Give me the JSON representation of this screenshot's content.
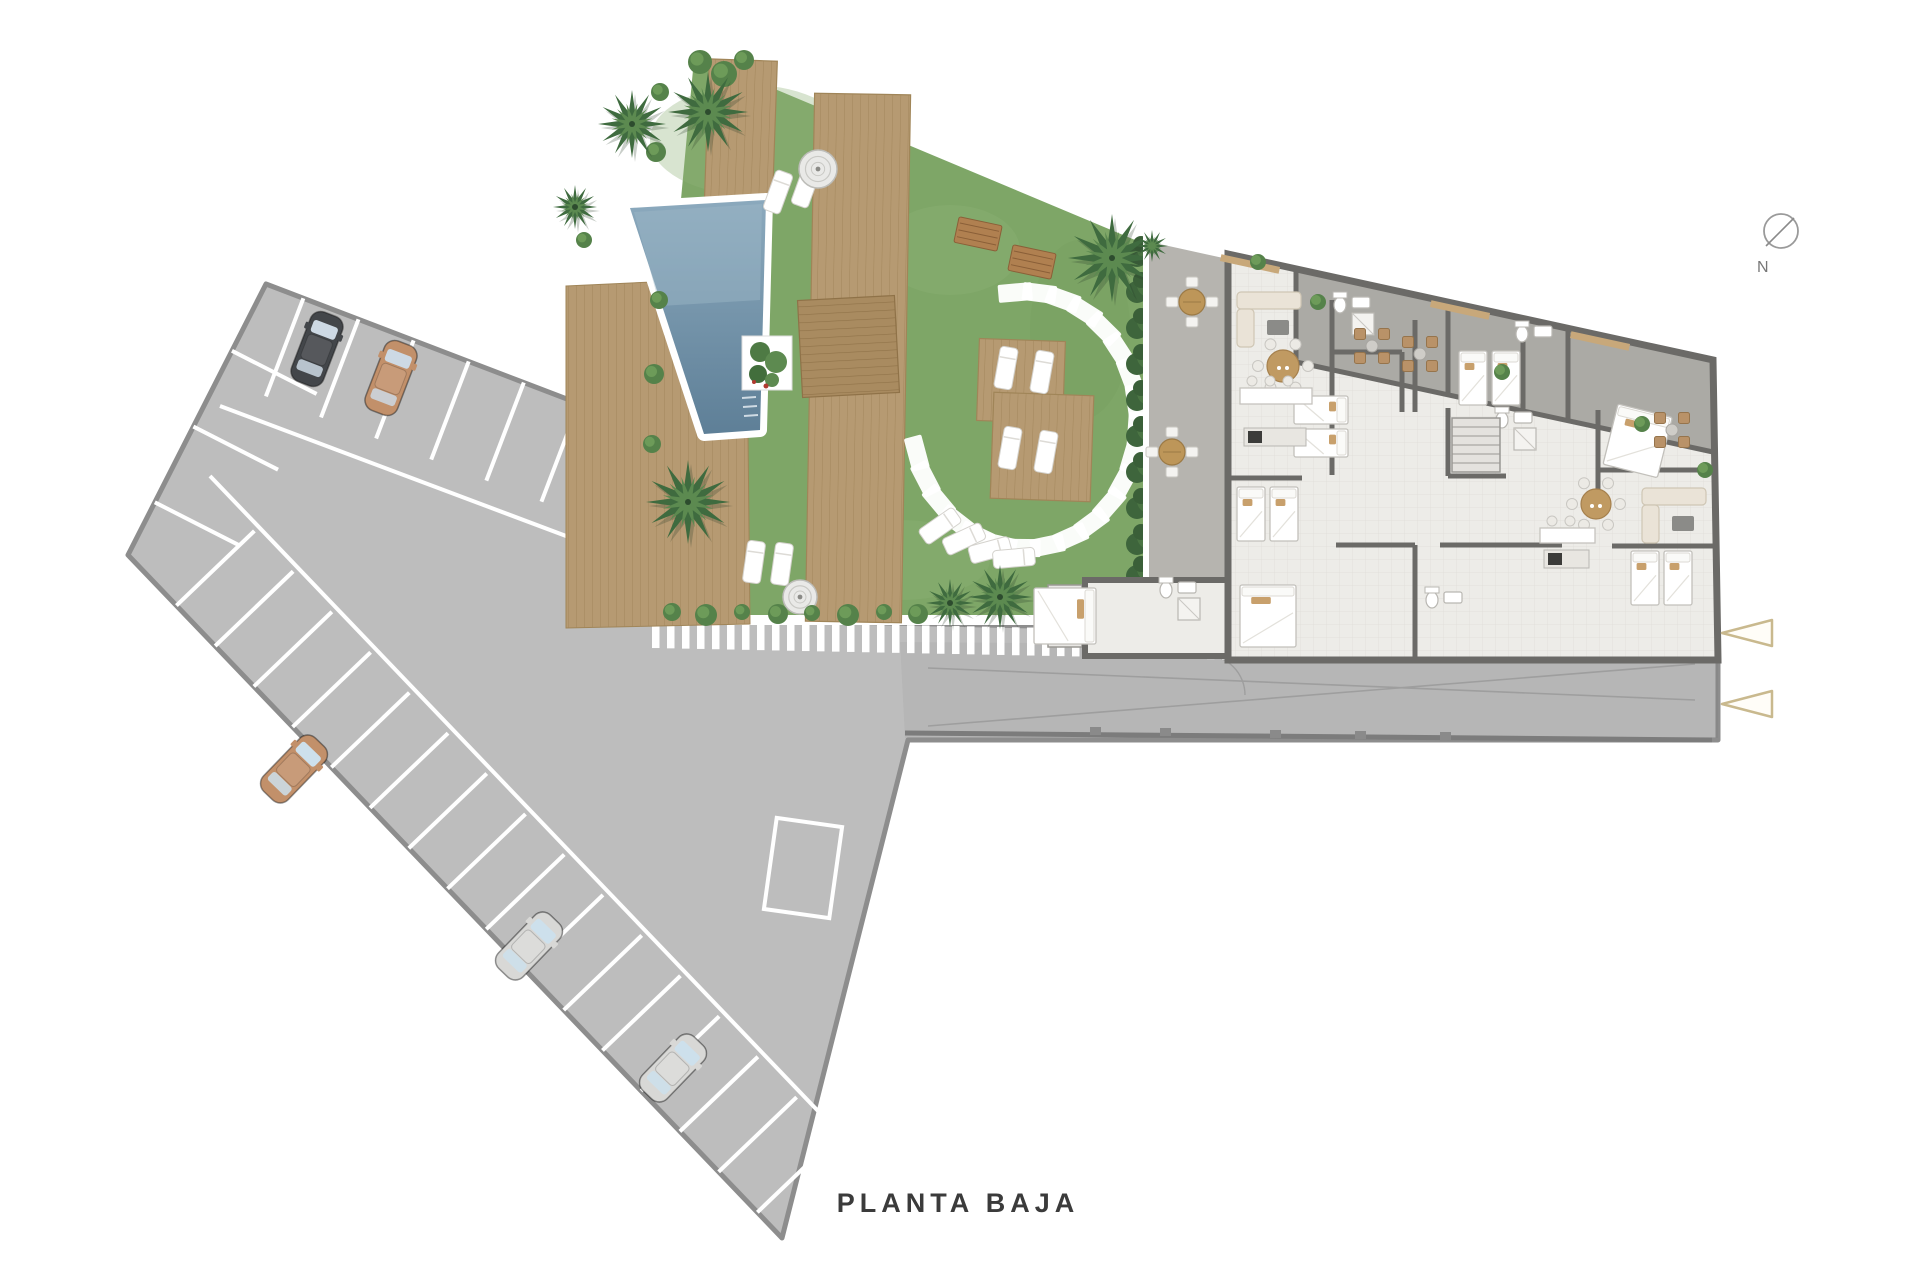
{
  "texts": {
    "title": "PLANTA BAJA"
  },
  "compass": {
    "label": "N",
    "cx": 1781,
    "cy": 231,
    "r": 17
  },
  "entrance_arrows": [
    {
      "x": 1722,
      "y": 633
    },
    {
      "x": 1722,
      "y": 704
    }
  ],
  "palette": {
    "paving": "#bdbdbd",
    "paving_border": "#8d8d8d",
    "grass": "#7ea667",
    "grass_light": "#8fb377",
    "deck": "#b69a72",
    "deck_line": "#a3875c",
    "deck_dark": "#a98b60",
    "deck_dark_line": "#8f7248",
    "pool_top": "#8ba9bd",
    "pool_bottom": "#5e7f97",
    "wall": "#6b6a67",
    "floor": "#edece8",
    "terrace": "#abaaa5",
    "patio": "#b6b4af",
    "hedge": "#3e653c",
    "palm_dark": "#3f6b3f",
    "palm_light": "#5c8a50",
    "arrow": "#c9b98e",
    "title": "#3b3b3b",
    "white": "#ffffff",
    "furniture_wood": "#c09a62",
    "cushion": "#c8a06c"
  },
  "parking": {
    "cars": [
      {
        "color": "#43464a",
        "glass": "#cdd9e4",
        "x": 317,
        "y": 349,
        "rot": 21
      },
      {
        "color": "#c2906a",
        "glass": "#cdd9e4",
        "x": 391,
        "y": 378,
        "rot": 21
      },
      {
        "color": "#c2906a",
        "glass": "#cde0ec",
        "x": 294,
        "y": 769,
        "rot": 44
      },
      {
        "color": "#d8d8d6",
        "glass": "#cde0ec",
        "x": 529,
        "y": 946,
        "rot": 44
      },
      {
        "color": "#d8d8d6",
        "glass": "#cde0ec",
        "x": 673,
        "y": 1068,
        "rot": 44
      }
    ]
  },
  "garden": {
    "pool_points": "630,208 766,200 760,430 704,434",
    "palms": [
      {
        "x": 632,
        "y": 124,
        "r": 34
      },
      {
        "x": 708,
        "y": 112,
        "r": 40
      },
      {
        "x": 688,
        "y": 502,
        "r": 42
      },
      {
        "x": 1112,
        "y": 258,
        "r": 44
      },
      {
        "x": 1000,
        "y": 597,
        "r": 32
      },
      {
        "x": 950,
        "y": 603,
        "r": 24
      },
      {
        "x": 575,
        "y": 207,
        "r": 22
      }
    ],
    "bushes": [
      {
        "x": 700,
        "y": 62,
        "r": 12
      },
      {
        "x": 724,
        "y": 74,
        "r": 13
      },
      {
        "x": 744,
        "y": 60,
        "r": 10
      },
      {
        "x": 660,
        "y": 92,
        "r": 9
      },
      {
        "x": 656,
        "y": 152,
        "r": 10
      },
      {
        "x": 659,
        "y": 300,
        "r": 9
      },
      {
        "x": 654,
        "y": 374,
        "r": 10
      },
      {
        "x": 652,
        "y": 444,
        "r": 9
      },
      {
        "x": 672,
        "y": 612,
        "r": 9
      },
      {
        "x": 706,
        "y": 615,
        "r": 11
      },
      {
        "x": 742,
        "y": 612,
        "r": 8
      },
      {
        "x": 778,
        "y": 614,
        "r": 10
      },
      {
        "x": 812,
        "y": 613,
        "r": 8
      },
      {
        "x": 848,
        "y": 615,
        "r": 11
      },
      {
        "x": 884,
        "y": 612,
        "r": 8
      },
      {
        "x": 918,
        "y": 614,
        "r": 10
      },
      {
        "x": 584,
        "y": 240,
        "r": 8
      }
    ],
    "hedge_x": 1143,
    "hedge_ys": [
      252,
      288,
      324,
      360,
      396,
      432,
      468,
      504,
      540,
      572
    ],
    "stones": {
      "cx": 1025,
      "cy": 420,
      "rx": 112,
      "ry": 128,
      "start": -95,
      "end": 165,
      "count": 22,
      "w": 34,
      "h": 18
    },
    "decks": [
      {
        "x": 706,
        "y": 60,
        "w": 68,
        "h": 192,
        "rot": 2,
        "dark": false
      },
      {
        "x": 810,
        "y": 94,
        "w": 96,
        "h": 528,
        "rot": 1,
        "dark": false
      },
      {
        "x": 800,
        "y": 298,
        "w": 97,
        "h": 97,
        "rot": -3,
        "dark": true
      },
      {
        "x": 978,
        "y": 340,
        "w": 86,
        "h": 82,
        "rot": 2,
        "dark": false
      },
      {
        "x": 992,
        "y": 394,
        "w": 100,
        "h": 106,
        "rot": 2,
        "dark": false
      }
    ],
    "deck_pool_left_points": "566,286 652,282 748,434 750,624 566,628",
    "planter": {
      "x": 742,
      "y": 336,
      "w": 50,
      "h": 54
    },
    "loungers": [
      {
        "x": 778,
        "y": 192,
        "rot": 20
      },
      {
        "x": 806,
        "y": 186,
        "rot": 20
      },
      {
        "x": 754,
        "y": 562,
        "rot": 8
      },
      {
        "x": 782,
        "y": 564,
        "rot": 8
      },
      {
        "x": 1006,
        "y": 368,
        "rot": 10
      },
      {
        "x": 1042,
        "y": 372,
        "rot": 10
      },
      {
        "x": 1010,
        "y": 448,
        "rot": 10
      },
      {
        "x": 1046,
        "y": 452,
        "rot": 10
      },
      {
        "x": 940,
        "y": 526,
        "rot": 55
      },
      {
        "x": 964,
        "y": 539,
        "rot": 65
      },
      {
        "x": 990,
        "y": 550,
        "rot": 75
      },
      {
        "x": 1014,
        "y": 558,
        "rot": 85
      }
    ],
    "showers": [
      {
        "x": 818,
        "y": 169,
        "r": 19
      },
      {
        "x": 800,
        "y": 597,
        "r": 17
      }
    ],
    "benches": [
      {
        "x": 978,
        "y": 234,
        "rot": 12
      },
      {
        "x": 1032,
        "y": 262,
        "rot": 12
      }
    ]
  },
  "patio": {
    "tables": [
      {
        "x": 1192,
        "y": 302
      },
      {
        "x": 1172,
        "y": 452
      }
    ],
    "tree": {
      "x": 1152,
      "y": 246,
      "r": 16
    }
  },
  "building": {
    "beds": [
      {
        "type": "twin",
        "x": 1237,
        "y": 487,
        "rot": 0
      },
      {
        "type": "twin",
        "x": 1348,
        "y": 396,
        "rot": 90
      },
      {
        "type": "twin",
        "x": 1459,
        "y": 351,
        "rot": 0
      },
      {
        "type": "double",
        "x": 1618,
        "y": 404,
        "rot": 14
      },
      {
        "type": "twin",
        "x": 1631,
        "y": 551,
        "rot": 0
      },
      {
        "type": "double",
        "x": 1096,
        "y": 588,
        "rot": 90
      },
      {
        "type": "double",
        "x": 1240,
        "y": 585,
        "rot": 0
      }
    ],
    "sofas": [
      {
        "x": 1237,
        "y": 292,
        "rot": 0
      },
      {
        "x": 1642,
        "y": 488,
        "rot": 0
      }
    ],
    "round_tables": [
      {
        "x": 1283,
        "y": 366,
        "r": 16
      },
      {
        "x": 1596,
        "y": 504,
        "r": 15
      }
    ],
    "terrace_sets": [
      {
        "x": 1372,
        "y": 346
      },
      {
        "x": 1420,
        "y": 354
      },
      {
        "x": 1672,
        "y": 430
      }
    ],
    "terrace_shrubs": [
      {
        "x": 1318,
        "y": 302
      },
      {
        "x": 1502,
        "y": 372
      },
      {
        "x": 1642,
        "y": 424
      },
      {
        "x": 1705,
        "y": 470
      },
      {
        "x": 1258,
        "y": 262
      }
    ],
    "kitchens": [
      {
        "x": 1240,
        "y": 388,
        "w": 72,
        "h": 16,
        "stools": 3,
        "appl_dy": 40
      },
      {
        "x": 1540,
        "y": 528,
        "w": 55,
        "h": 15,
        "stools": 2,
        "appl_dy": 22
      }
    ],
    "baths": [
      {
        "x": 1340,
        "y": 305,
        "shower": true
      },
      {
        "x": 1522,
        "y": 334,
        "shower": false
      },
      {
        "x": 1502,
        "y": 420,
        "shower": true
      },
      {
        "x": 1166,
        "y": 590,
        "shower": true
      },
      {
        "x": 1432,
        "y": 600,
        "shower": false
      }
    ],
    "stairs": {
      "x": 1452,
      "y": 418,
      "w": 48,
      "h": 54,
      "steps": 6
    },
    "ext_steps": {
      "x": 1048,
      "y": 585,
      "w": 34,
      "h": 62,
      "steps": 6
    },
    "lintels": [
      {
        "x": 1250,
        "y": 264
      },
      {
        "x": 1460,
        "y": 310
      },
      {
        "x": 1600,
        "y": 341
      }
    ]
  }
}
